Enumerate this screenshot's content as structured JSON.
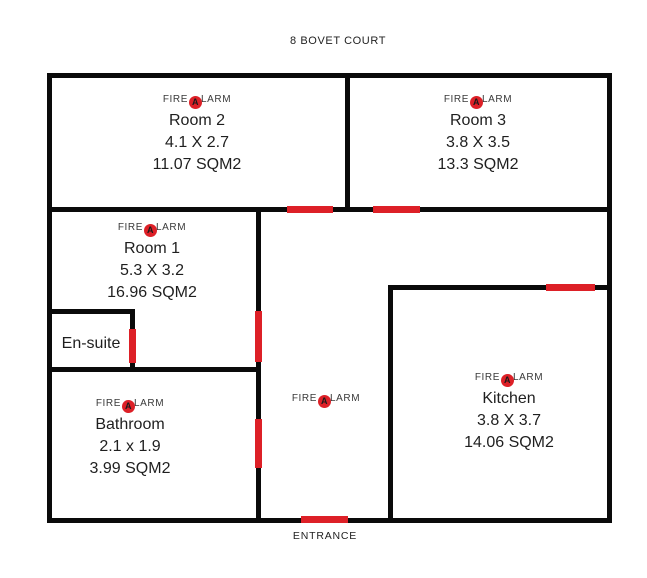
{
  "title": "8 BOVET COURT",
  "plan": {
    "entrance_label": "ENTRANCE",
    "fire_alarm_label": {
      "prefix": "FIRE",
      "icon": "fire-alarm-icon",
      "icon_letter": "A",
      "suffix": "LARM"
    },
    "colors": {
      "wall": "#0a0a0a",
      "door_marker": "#dd2027",
      "text": "#1f1f1f"
    },
    "rooms": {
      "room2": {
        "name": "Room 2",
        "dimensions": "4.1 X 2.7",
        "area": "11.07 SQM2"
      },
      "room3": {
        "name": "Room 3",
        "dimensions": "3.8 X 3.5",
        "area": "13.3 SQM2"
      },
      "room1": {
        "name": "Room 1",
        "dimensions": "5.3 X 3.2",
        "area": "16.96 SQM2"
      },
      "ensuite": {
        "name": "En-suite"
      },
      "bathroom": {
        "name": "Bathroom",
        "dimensions": "2.1 x 1.9",
        "area": "3.99 SQM2"
      },
      "kitchen": {
        "name": "Kitchen",
        "dimensions": "3.8 X 3.7",
        "area": "14.06 SQM2"
      }
    }
  }
}
